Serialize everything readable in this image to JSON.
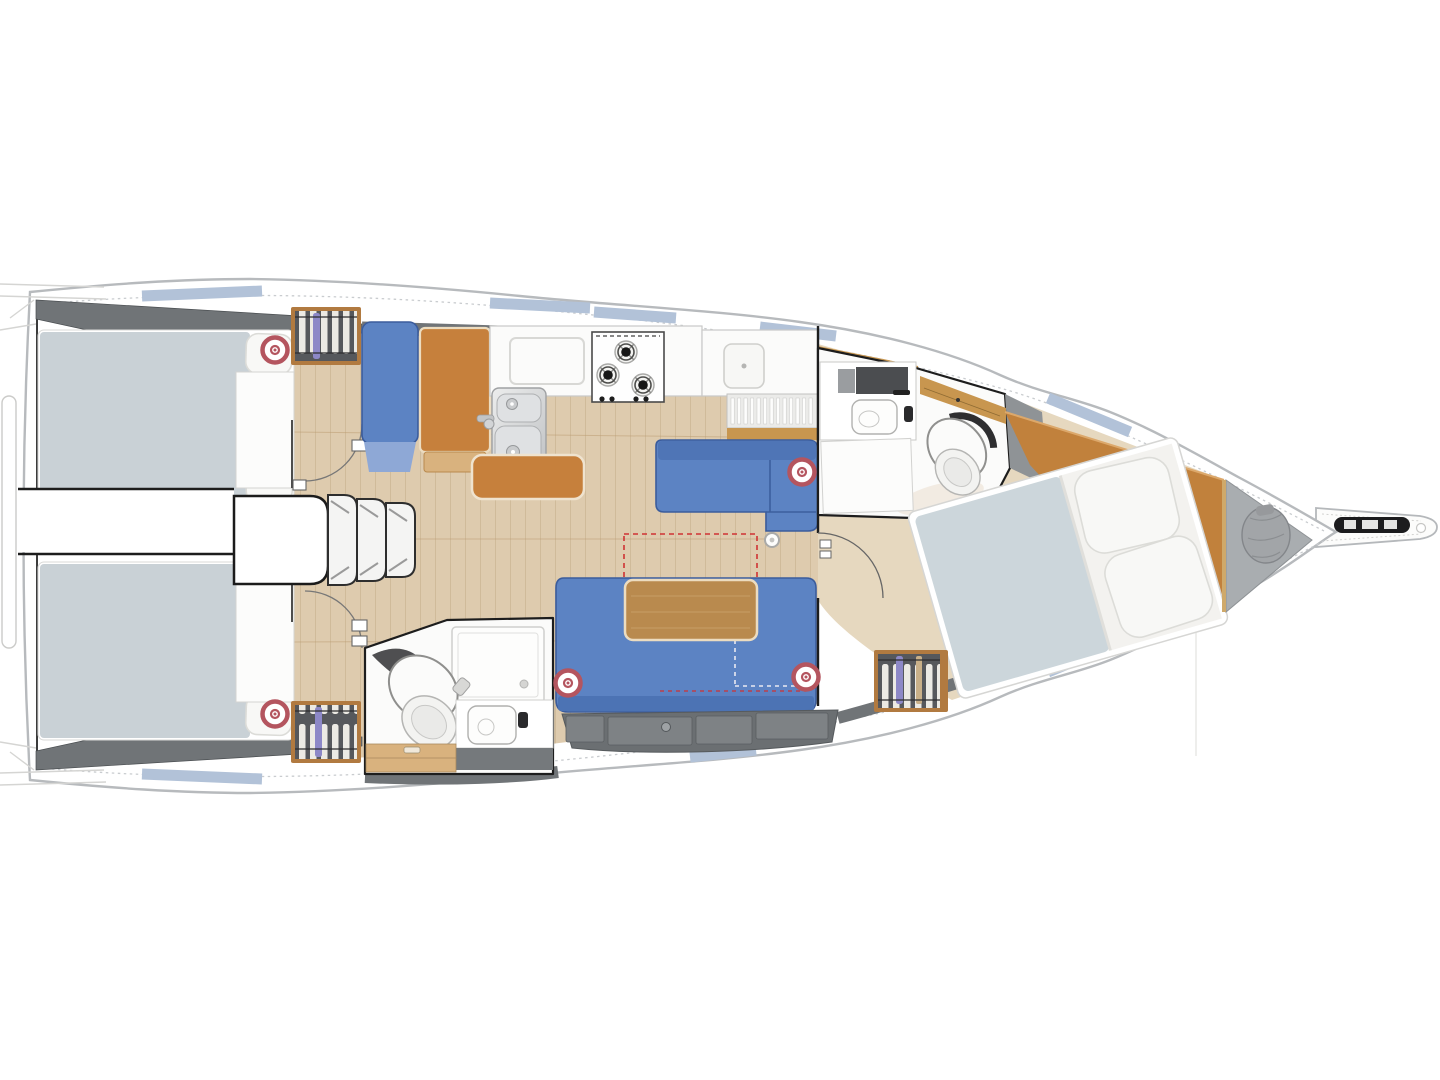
{
  "diagram": {
    "kind": "yacht-interior-floor-plan",
    "view": "top-down",
    "orientation": "bow-right"
  },
  "palette": {
    "hull_fill": "#ffffff",
    "hull_stroke": "#b7babd",
    "seam": "#c9cccf",
    "window_blue": "#b2c2d8",
    "deck_dark": "#707477",
    "floor_wood": "#decbae",
    "floor_fwd": "#e6d8bf",
    "head_floor": "#f2ebe2",
    "room_white": "#fbfbfa",
    "wall": "#1d1d1d",
    "wood_orange": "#c1813c",
    "wood_light": "#d9b27e",
    "wood_tan": "#c8964f",
    "wood_frame": "#b17a40",
    "table_wood": "#b98a4e",
    "table_edge": "#ecdcc0",
    "upholstery": "#5c83c3",
    "upholstery_dark": "#4c73b4",
    "upholstery_edge": "#3b5c9c",
    "bed_gray": "#c9d1d6",
    "fwd_bed_gray": "#ccd6db",
    "pillow": "#f8f8f6",
    "pillow_edge": "#dcdcd8",
    "locker": "#6b6f72",
    "locker_lid": "#7e8285",
    "marker_red": "#b4555f",
    "anchor_gray": "#a9adb0",
    "bag_gray": "#a2a5a8",
    "clothes_bg": "#56585c",
    "clothes_bar": "#eceae4",
    "clothes_accent": "#8d88c7",
    "clothes_tan": "#c9b089",
    "dashed_red": "#cf3333",
    "dark_fitting": "#1c1c1e"
  },
  "speaker_markers": {
    "shape": "ring",
    "positions": [
      [
        275,
        350
      ],
      [
        275,
        714
      ],
      [
        802,
        472
      ],
      [
        568,
        683
      ],
      [
        806,
        677
      ]
    ]
  },
  "hull_windows": [
    [
      142,
      296,
      262,
      291
    ],
    [
      490,
      303,
      590,
      308
    ],
    [
      594,
      312,
      676,
      318
    ],
    [
      760,
      327,
      836,
      336
    ],
    [
      1048,
      398,
      1130,
      432
    ],
    [
      142,
      774,
      262,
      779
    ],
    [
      424,
      773,
      548,
      767
    ],
    [
      690,
      757,
      756,
      750
    ],
    [
      1048,
      672,
      1130,
      638
    ]
  ],
  "features": [
    "aft-cabin-starboard",
    "aft-cabin-port",
    "engine-box-corridor",
    "companionway-steps",
    "hanging-wardrobes",
    "nav-seat",
    "chart-table",
    "galley-sink",
    "galley-stove",
    "dish-rack",
    "galley-island",
    "starboard-settee",
    "port-settee",
    "salon-table",
    "optional-table-outline",
    "aft-head-toilet",
    "aft-head-shower",
    "aft-head-vanity",
    "fwd-head-toilet",
    "fwd-head-vanity",
    "fwd-cabin-berth",
    "fwd-wardrobe",
    "anchor-locker",
    "sail-bag",
    "bowsprit-anchor-roller"
  ]
}
